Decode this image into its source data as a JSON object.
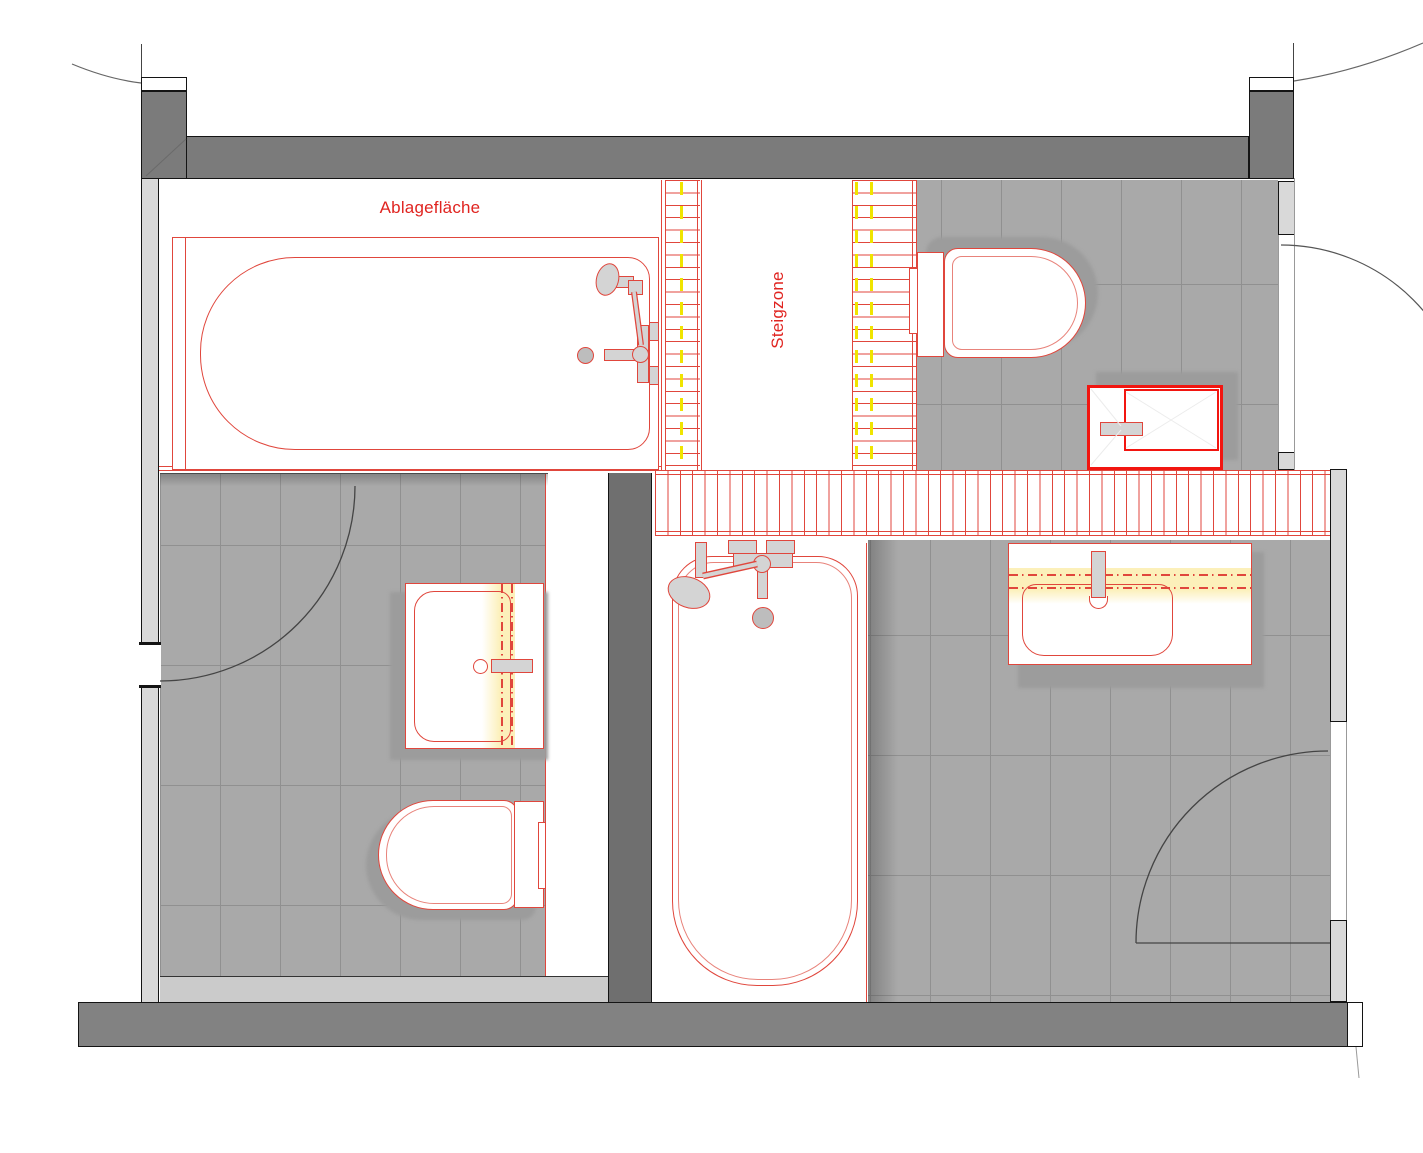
{
  "title": "bathroom-floor-plan",
  "labels": {
    "ablageflaeche": "Ablagefläche",
    "steigzone": "Steigzone"
  },
  "colors": {
    "red_line": "#e0463c",
    "red_strong": "#f21510",
    "red_soft": "#e8837b",
    "red_text": "#e02420",
    "yellow_dash": "#f0e400",
    "cream_band": "#fcf0ba",
    "wall_dark": "#7b7b7b",
    "wall_partition": "#6f6f6f",
    "wall_light": "#d9d9d9",
    "wall_bottom": "#828282",
    "tile_fill": "#a9a9a9",
    "tile_line": "#909090",
    "fixture_shadow": "#9c9c9c",
    "fixture_gray": "#d4d4d4"
  },
  "fixtures": {
    "bathtub_top": "bathtub-plan-symbol",
    "bathtub_bottom": "bathtub-plan-symbol",
    "toilet_top_right": "wall-hung-wc-symbol",
    "toilet_bottom_left": "wall-hung-wc-symbol",
    "sink_bottom_left": "washbasin-symbol",
    "sink_bottom_right": "washbasin-symbol",
    "shower_top_right": "shower-tray-symbol"
  }
}
